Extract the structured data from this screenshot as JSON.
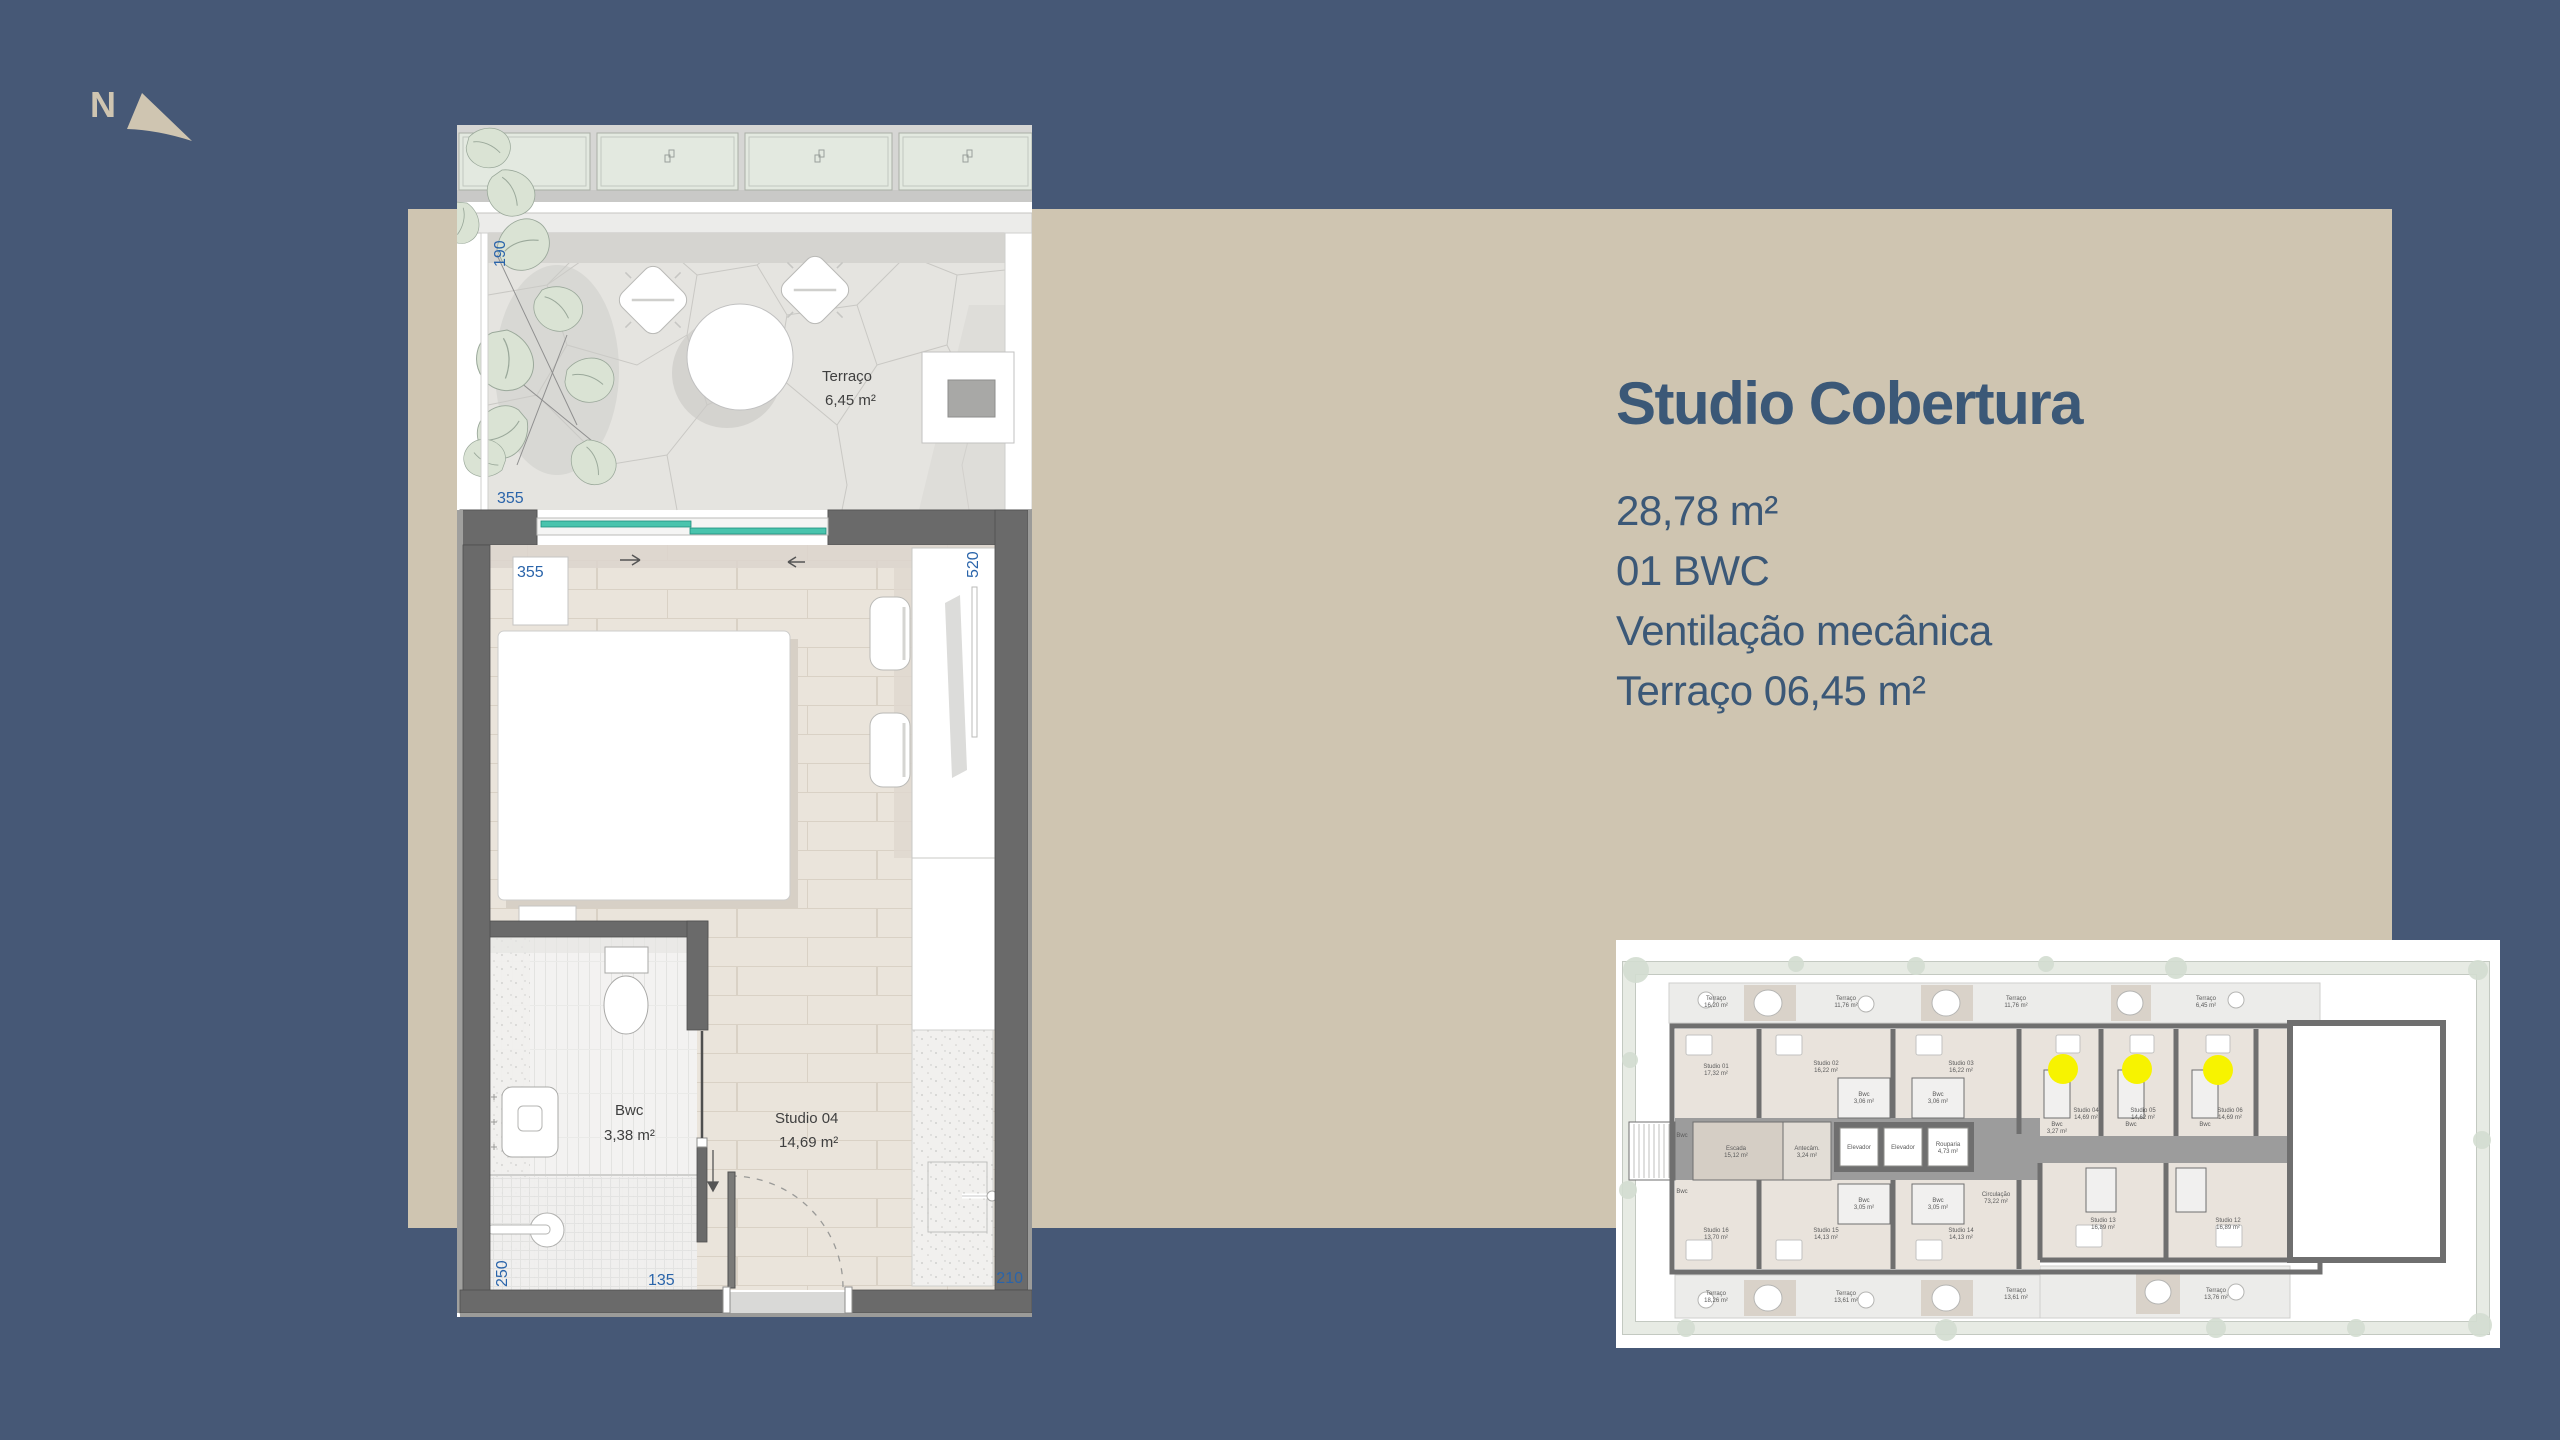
{
  "colors": {
    "background": "#465876",
    "panel": "#cfc5b1",
    "heading_text": "#3b5877",
    "dimension_blue": "#2a64aa",
    "wall_gray": "#6a6a6a",
    "glass_teal": "#45c3ab",
    "highlight_yellow": "#f7f300"
  },
  "compass": {
    "label": "N"
  },
  "info": {
    "title": "Studio Cobertura",
    "lines": [
      "28,78 m²",
      "01 BWC",
      "Ventilação mecânica",
      "Terraço 06,45 m²"
    ]
  },
  "plan": {
    "terrace": {
      "name": "Terraço",
      "area": "6,45 m²"
    },
    "bwc": {
      "name": "Bwc",
      "area": "3,38 m²"
    },
    "studio": {
      "name": "Studio 04",
      "area": "14,69 m²"
    },
    "dims": {
      "terrace_depth": "190",
      "terrace_width": "355",
      "room_width": "355",
      "room_depth": "520",
      "bed_wall": "260",
      "bwc_depth": "250",
      "bwc_width": "135",
      "closet_width": "210"
    }
  },
  "miniplan": {
    "rooms": {
      "s01": {
        "n": "Studio 01",
        "a": "17,32 m²"
      },
      "s02": {
        "n": "Studio 02",
        "a": "16,22 m²"
      },
      "s03": {
        "n": "Studio 03",
        "a": "16,22 m²"
      },
      "s04": {
        "n": "Studio 04",
        "a": "14,69 m²"
      },
      "s05": {
        "n": "Studio 05",
        "a": "14,62 m²"
      },
      "s06": {
        "n": "Studio 06",
        "a": "14,69 m²"
      },
      "s12": {
        "n": "Studio 12",
        "a": "16,89 m²"
      },
      "s13": {
        "n": "Studio 13",
        "a": "16,89 m²"
      },
      "s14": {
        "n": "Studio 14",
        "a": "14,13 m²"
      },
      "s15": {
        "n": "Studio 15",
        "a": "14,13 m²"
      },
      "s16": {
        "n": "Studio 16",
        "a": "13,70 m²"
      },
      "bwc_top": {
        "n": "Bwc",
        "a": "3,06 m²"
      },
      "bwc_right": {
        "n": "Bwc",
        "a": "3,27 m²"
      },
      "bwc_left": {
        "n": "Bwc",
        "a": "3,12 m²"
      },
      "bwc_bottom": {
        "n": "Bwc",
        "a": "3,05 m²"
      },
      "escada": {
        "n": "Escada",
        "a": "15,12 m²"
      },
      "antecam": {
        "n": "Antecâm.",
        "a": "3,24 m²"
      },
      "elevador": {
        "n": "Elevador",
        "a": ""
      },
      "rouparia": {
        "n": "Rouparia",
        "a": "4,73 m²"
      },
      "circulacao": {
        "n": "Circulação",
        "a": "73,22 m²"
      },
      "t1": {
        "n": "Terraço",
        "a": "16,20 m²"
      },
      "t2": {
        "n": "Terraço",
        "a": "11,76 m²"
      },
      "t_right": {
        "n": "Terraço",
        "a": "6,45 m²"
      },
      "t4": {
        "n": "Terraço",
        "a": "18,26 m²"
      },
      "t5": {
        "n": "Terraço",
        "a": "13,61 m²"
      },
      "t6": {
        "n": "Terraço",
        "a": "13,76 m²"
      }
    }
  }
}
